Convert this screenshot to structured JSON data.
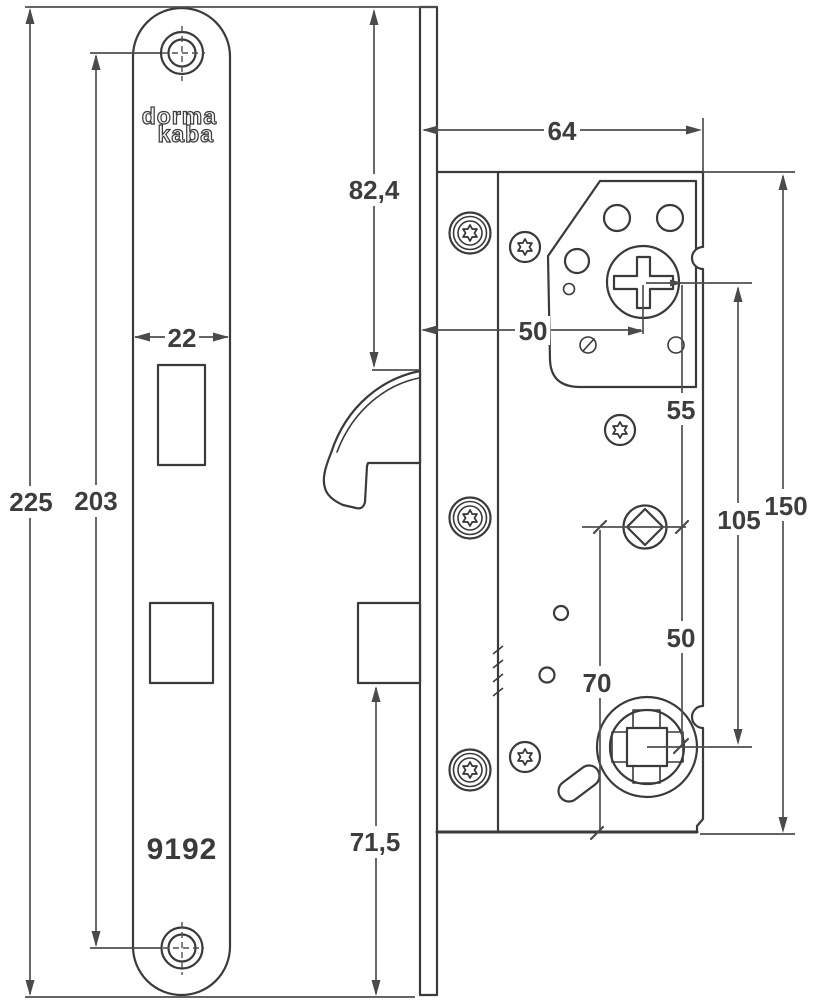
{
  "drawing": {
    "brand": {
      "line1": "dorma",
      "line2": "kaba"
    },
    "model_number": "9192",
    "colors": {
      "outline": "#3a3a3a",
      "dimension_lines": "#4f4f4f",
      "label_text": "#3d3d3d",
      "background": "#ffffff"
    },
    "icons": {
      "torx_screw": "torx-screw-icon",
      "phillips_cylinder_hub": "phillips-hub-icon",
      "square_spindle_follower": "square-follower-icon",
      "diamond_spindle_hole": "diamond-hole-icon",
      "screw_hole": "screw-hole-icon"
    },
    "dimensions": {
      "faceplate_overall_height": "225",
      "faceplate_screw_spacing": "203",
      "faceplate_width": "22",
      "top_to_latch": "82,4",
      "deadbolt_to_bottom": "71,5",
      "case_depth": "64",
      "backset": "50",
      "cylinder_to_spindle": "55",
      "spindle_to_follower": "50",
      "cylinder_to_follower": "105",
      "case_height": "150",
      "spindle_to_case_bottom": "70"
    }
  }
}
